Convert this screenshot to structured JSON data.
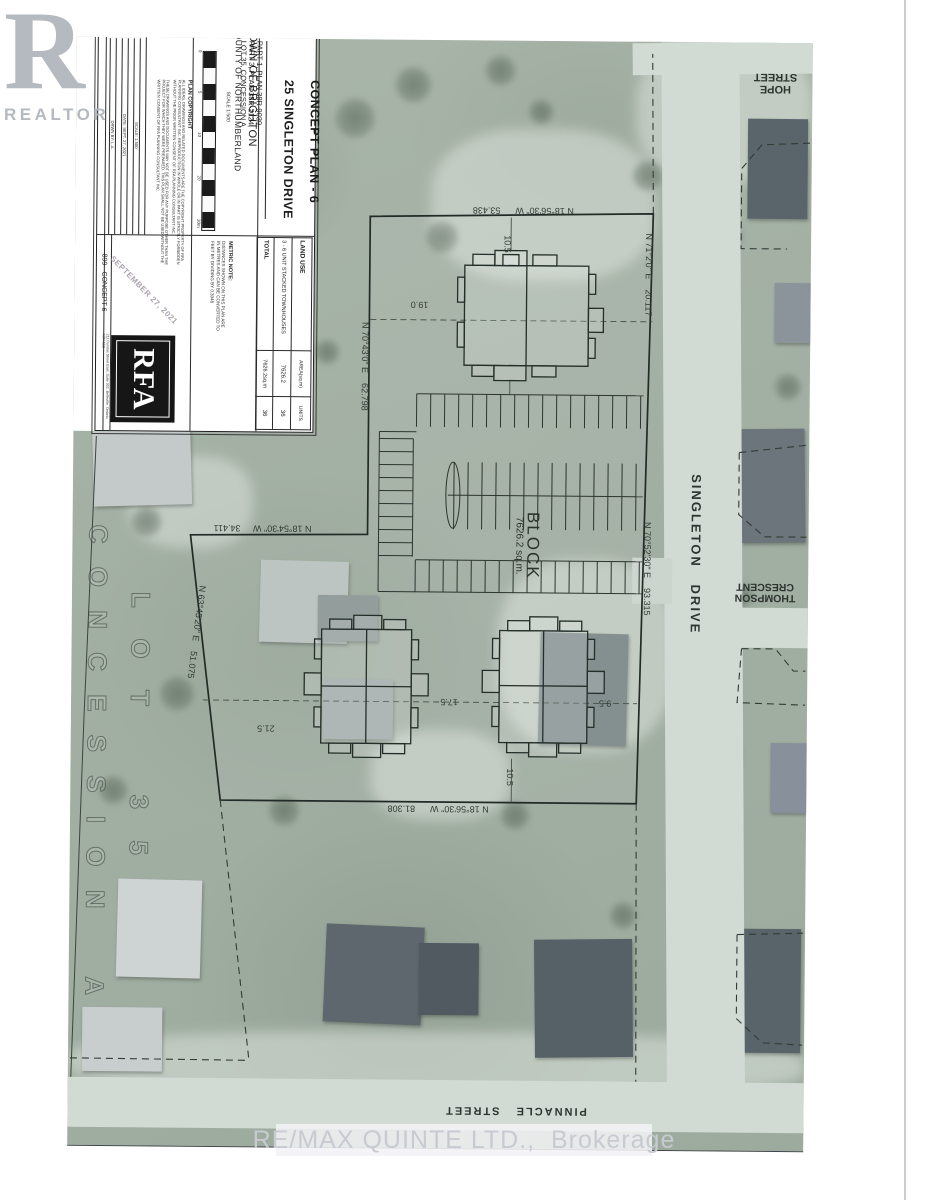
{
  "page": {
    "background": "#ffffff",
    "paper_edge_color": "#caccd0"
  },
  "realtor_logo": {
    "letter": "R",
    "label": "REALTOR",
    "color": "#b5b9c0"
  },
  "watermark": {
    "text": "RE/MAX QUINTE LTD.,  Brokerage",
    "color": "#c7cad0"
  },
  "title_block": {
    "title_line1": "CONCEPT PLAN - 6",
    "title_line2": "25 SINGLETON DRIVE",
    "part_line1": "PART 1, PLAN 38R-9039,",
    "part_line2": "PART 3, PLAN 38R-2124,",
    "part_line3": "LOT 35, CONCESSION A",
    "municipality_line1": "TOWN OF BRIGHTON",
    "municipality_line2": "COUNTY OF NORTHUMBERLAND",
    "scale_label": "SCALE 1:500",
    "scale_ticks": [
      "0",
      "5",
      "10",
      "20",
      "30m"
    ],
    "metric_note_title": "METRIC NOTE:",
    "metric_note_body": "DISTANCES SHOWN ON THIS PLAN ARE IN METRES AND CAN BE CONVERTED TO FEET BY DIVIDING BY 0.3048",
    "copyright_title": "PLAN COPYRIGHT",
    "copyright_para1": "ALL IDEAS, DRAWINGS AND RELATED DOCUMENTS ARE THE COPYRIGHT PROPERTY OF RFA PLANNING CONSULTANT INC. REPRODUCTION IN WHOLE OR IN PART IS STRICTLY FORBIDDEN WITHOUT THE PRIOR WRITTEN CONSENT OF RFA PLANNING CONSULTANT INC.",
    "copyright_para2": "THESE DRAWINGS AND DOCUMENTS MAY NOT BE USED FOR ANY PURPOSE OTHER THAN THE PROJECT FOR WHICH THEY WERE PREPARED. THIS PLAN SHALL NOT BE USED WITHOUT THE WRITTEN CONSENT OF RFA PLANNING CONSULTANT INC.",
    "revision_label1": "DRWN BY: L.A.",
    "revision_label2": "DATE: SEPT. 27, 2021",
    "revision_label3": "SCALE: 1:500",
    "job_number": "899 - CONCEPT 6",
    "date_stamp": "SEPTEMBER 27, 2021",
    "firm_logo_text": "RFA",
    "firm_address": "211 Dundas Street East, Suite 302, Belleville, Ontario, K8N 1E2",
    "land_use_table": {
      "headers": [
        "LAND USE",
        "AREA(sq.m)",
        "UNITS"
      ],
      "rows": [
        [
          "3 - 6 UNIT STACKED TOWNHOUSES",
          "7626.2",
          "36"
        ],
        [
          "TOTAL",
          "7626.2sq.m",
          "36"
        ]
      ]
    }
  },
  "map": {
    "streets": {
      "hope_line1": "HOPE",
      "hope_line2": "STREET",
      "singleton": "SINGLETON   DRIVE",
      "thompson_line1": "THOMPSON",
      "thompson_line2": "CRESCENT",
      "pinnacle": "PINNACLE   STREET"
    },
    "lot_label": "L O T    3 5",
    "concession_label": "C O N C E S S I O N    A",
    "block_label": "BLOCK",
    "block_area": "7626.2 sq.m.",
    "bearings": {
      "north": "N 18°56'30\" W      53.438",
      "east_upper": "N 71°2'0\" E    20.117",
      "east_lower": "N 70°52'30\" E    93.315",
      "west": "N 70°43'0\" E    62.798",
      "inner_west": "N 18°54'30\" W     34.411",
      "diagonal": "N 63°45'20\" E    51.075",
      "south": "N 18°56'30\" W      81.308"
    },
    "dimensions": {
      "top_setback": "10.5",
      "west_setback": "19.0",
      "left_setback": "21.5",
      "between_buildings": "17.5",
      "right_setback": "9.5",
      "bottom_setback": "10.5"
    }
  }
}
